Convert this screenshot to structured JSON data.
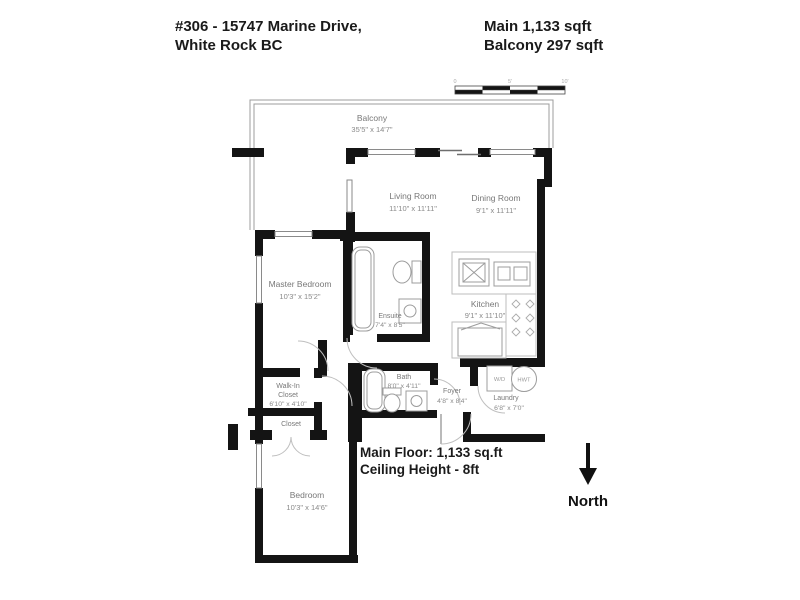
{
  "header": {
    "address_line1": "#306 - 15747 Marine Drive,",
    "address_line2": "White Rock BC",
    "area_line1": "Main 1,133 sqft",
    "area_line2": "Balcony 297 sqft"
  },
  "rooms": {
    "balcony": {
      "name": "Balcony",
      "dims": "35'5\" x 14'7\""
    },
    "living": {
      "name": "Living Room",
      "dims": "11'10\" x 11'11\""
    },
    "dining": {
      "name": "Dining Room",
      "dims": "9'1\" x 11'11\""
    },
    "master": {
      "name": "Master Bedroom",
      "dims": "10'3\" x 15'2\""
    },
    "ensuite": {
      "name": "Ensuite",
      "dims": "7'4\" x 8'5\""
    },
    "kitchen": {
      "name": "Kitchen",
      "dims": "9'1\" x 11'10\""
    },
    "walkin": {
      "name_line1": "Walk-In",
      "name_line2": "Closet",
      "dims": "6'10\" x 4'10\""
    },
    "bath": {
      "name": "Bath",
      "dims": "8'0\" x 4'11\""
    },
    "foyer": {
      "name": "Foyer",
      "dims": "4'8\" x 8'4\""
    },
    "laundry": {
      "name": "Laundry",
      "dims": "6'8\" x 7'0\""
    },
    "closet": {
      "name": "Closet"
    },
    "bedroom": {
      "name": "Bedroom",
      "dims": "10'3\" x 14'6\""
    }
  },
  "fixtures": {
    "washer_dryer": "W/D",
    "hot_water_tank": "HWT"
  },
  "notes": {
    "line1": "Main Floor: 1,133 sq.ft",
    "line2": "Ceiling Height - 8ft"
  },
  "compass": {
    "label": "North"
  },
  "scale_bar": {
    "tick0": "0",
    "tick1": "5'",
    "tick2": "10'"
  },
  "colors": {
    "wall": "#141414",
    "balcony_line": "#aaaaaa",
    "label_gray": "#787878",
    "text_black": "#1a1a1a"
  }
}
